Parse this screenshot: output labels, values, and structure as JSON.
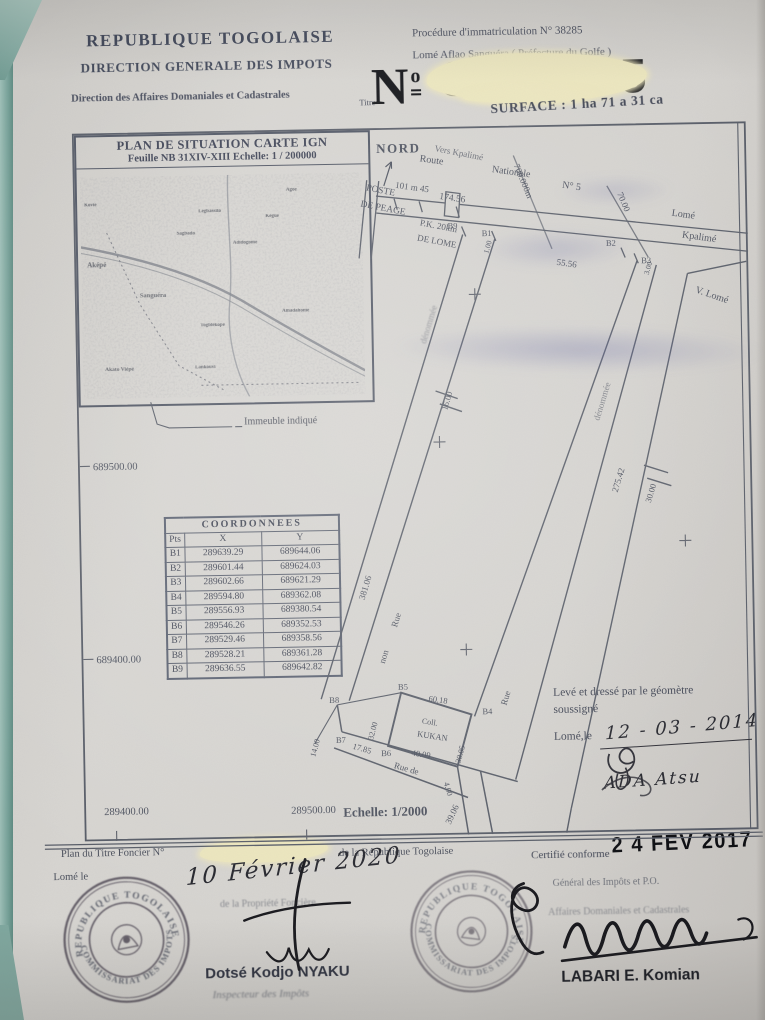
{
  "colors": {
    "paper": "#d5d3cf",
    "ink": "#474c59",
    "teal_edge": "#7ba79d",
    "highlight": "#ece6bd",
    "stamp_ink": "#4a4350",
    "black_ink": "#14151a"
  },
  "header": {
    "republic": "REPUBLIQUE TOGOLAISE",
    "direction": "DIRECTION GENERALE DES IMPOTS",
    "sub_direction": "Direction des Affaires Domaniales et Cadastrales",
    "procedure": "Procédure d'immatriculation N° 38285",
    "location": "Lomé Aflao Sanguéra ( Préfecture du Golfe )",
    "titre": "Titre",
    "numero_symbol": "N",
    "numero_ordinal": "o",
    "numero_masked": "31755",
    "surface": "SURFACE : 1 ha 71 a 31 ca"
  },
  "inset": {
    "title": "PLAN DE SITUATION CARTE IGN",
    "subtitle": "Feuille NB 31XIV-XIII Echelle: 1 / 200000",
    "legend": "Immeuble indiqué",
    "places": [
      "Aképé",
      "Sanguéra",
      "Sagbado",
      "Légbassito",
      "Adidogomé",
      "Kégué",
      "Amadahomé",
      "Togblékopé",
      "Akato Viépé",
      "Lankouvi",
      "Agoè",
      "Kovié"
    ]
  },
  "plan": {
    "nord": "NORD",
    "vers_kpalime": "Vers Kpalimé",
    "route": "Route",
    "nationale": "Nationale",
    "n5": "N° 5",
    "poste_1": "POSTE",
    "poste_2": "DE PEAGE",
    "pk_1": "P.K. 20km",
    "pk_2": "DE LOME",
    "d_101": "101 m 45",
    "d_174": "174.56",
    "d_700": "700.000m",
    "d_70": "70.00",
    "d_55": "55.56",
    "d_3": "3.00",
    "d_1": "1.00",
    "lome": "Lomé",
    "kpalime": "Kpalimé",
    "v_lome": "V. Lomé",
    "b1": "B1",
    "b2": "B2",
    "b3": "B3",
    "b4": "B4",
    "b5": "B5",
    "b6": "B6",
    "b7": "B7",
    "b8": "B8",
    "b9": "B9",
    "d_381": "381.06",
    "d_275": "275.42",
    "d_16": "16.00",
    "d_30": "30.00",
    "rue": "Rue",
    "non": "non",
    "denommee": "dénommée",
    "rue_de": "Rue de",
    "d_60": "60.18",
    "d_3005": "30.05",
    "d_4009": "40.09",
    "d_1785": "17.85",
    "d_3200": "32.00",
    "d_1400": "14.00",
    "d_400": "4.00",
    "d_3906": "39.06",
    "coll": "Coll.",
    "kukan": "KUKAN",
    "grid_n1": "689500.00",
    "grid_n2": "689400.00",
    "grid_e1": "289400.00",
    "grid_e2": "289500.00",
    "echelle": "Echelle: 1/2000"
  },
  "table": {
    "title": "COORDONNEES",
    "columns": [
      "Pts",
      "X",
      "Y"
    ],
    "rows": [
      [
        "B1",
        "289639.29",
        "689644.06"
      ],
      [
        "B2",
        "289601.44",
        "689624.03"
      ],
      [
        "B3",
        "289602.66",
        "689621.29"
      ],
      [
        "B4",
        "289594.80",
        "689362.08"
      ],
      [
        "B5",
        "289556.93",
        "689380.54"
      ],
      [
        "B6",
        "289546.26",
        "689352.53"
      ],
      [
        "B7",
        "289529.46",
        "689358.56"
      ],
      [
        "B8",
        "289528.21",
        "689361.28"
      ],
      [
        "B9",
        "289636.55",
        "689642.82"
      ]
    ]
  },
  "surveyor": {
    "line1": "Levé et dressé par le géomètre",
    "line2": "soussigné",
    "lome_le": "Lomé,le",
    "date": "12 - 03 - 2014",
    "name": "ADA Atsu"
  },
  "footer": {
    "plan_pre": "Plan du Titre Foncier N°",
    "plan_post": "de la République Togolaise",
    "lome_le": "Lomé le",
    "date_hand": "10 Février 2020",
    "fonciere": "de la Propriété Foncière",
    "certifie": "Certifié conforme",
    "date_stamp": "2 4 FEV 2017",
    "dg_line": "Général des Impôts et P.O.",
    "dadc_line": "Affaires Domaniales et Cadastrales",
    "name_left": "Dotsé Kodjo NYAKU",
    "title_left": "Inspecteur des Impôts",
    "name_right": "LABARI E. Komian"
  },
  "stamps": {
    "ring_top": "REPUBLIQUE TOGOLAISE",
    "ring_bottom": "COMMISSARIAT DES IMPOTS"
  }
}
